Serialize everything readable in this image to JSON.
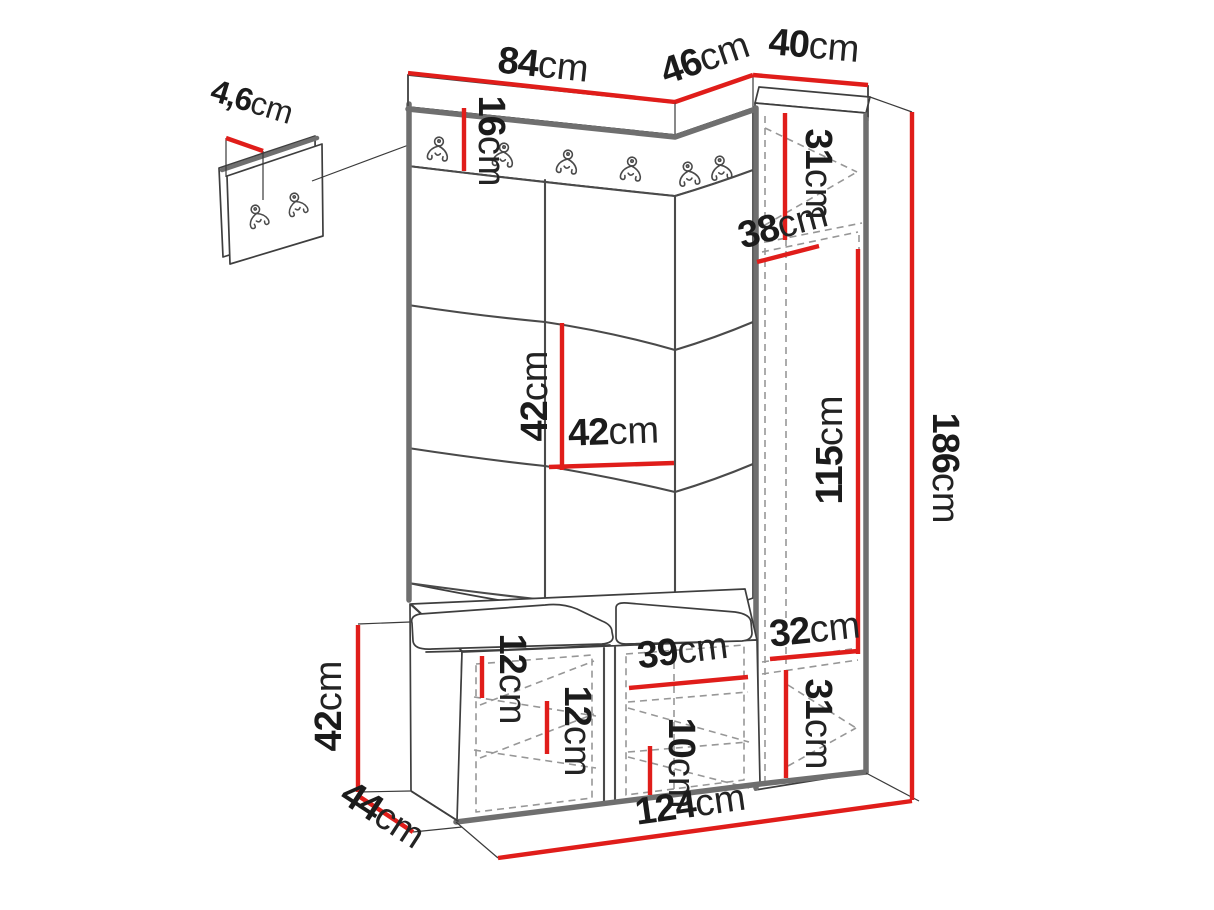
{
  "unit": "cm",
  "colors": {
    "dimension_red": "#e01d1a",
    "outline": "#3e3e3e",
    "accent_gray": "#6f6f6f",
    "dashed_gray": "#979797",
    "label_text": "#1b1b1b"
  },
  "dimensions": {
    "top_left_width": {
      "value": "84",
      "unit": "cm"
    },
    "top_corner_width": {
      "value": "46",
      "unit": "cm"
    },
    "top_right_width": {
      "value": "40",
      "unit": "cm"
    },
    "panel_thickness": {
      "value": "4,6",
      "unit": "cm"
    },
    "rail_height": {
      "value": "16",
      "unit": "cm"
    },
    "cabinet_top_compartment": {
      "value": "31",
      "unit": "cm"
    },
    "cabinet_depth": {
      "value": "38",
      "unit": "cm"
    },
    "tile_height": {
      "value": "42",
      "unit": "cm"
    },
    "tile_width": {
      "value": "42",
      "unit": "cm"
    },
    "cabinet_door_height": {
      "value": "115",
      "unit": "cm"
    },
    "total_height": {
      "value": "186",
      "unit": "cm"
    },
    "cabinet_inner_width": {
      "value": "32",
      "unit": "cm"
    },
    "cabinet_bottom_compartment": {
      "value": "31",
      "unit": "cm"
    },
    "bench_top_clearance": {
      "value": "12",
      "unit": "cm"
    },
    "bench_shelf_clearance": {
      "value": "12",
      "unit": "cm"
    },
    "bench_compartment_width": {
      "value": "39",
      "unit": "cm"
    },
    "bench_lower_clearance": {
      "value": "10",
      "unit": "cm"
    },
    "bench_height": {
      "value": "42",
      "unit": "cm"
    },
    "bench_depth": {
      "value": "44",
      "unit": "cm"
    },
    "base_width": {
      "value": "124",
      "unit": "cm"
    }
  }
}
